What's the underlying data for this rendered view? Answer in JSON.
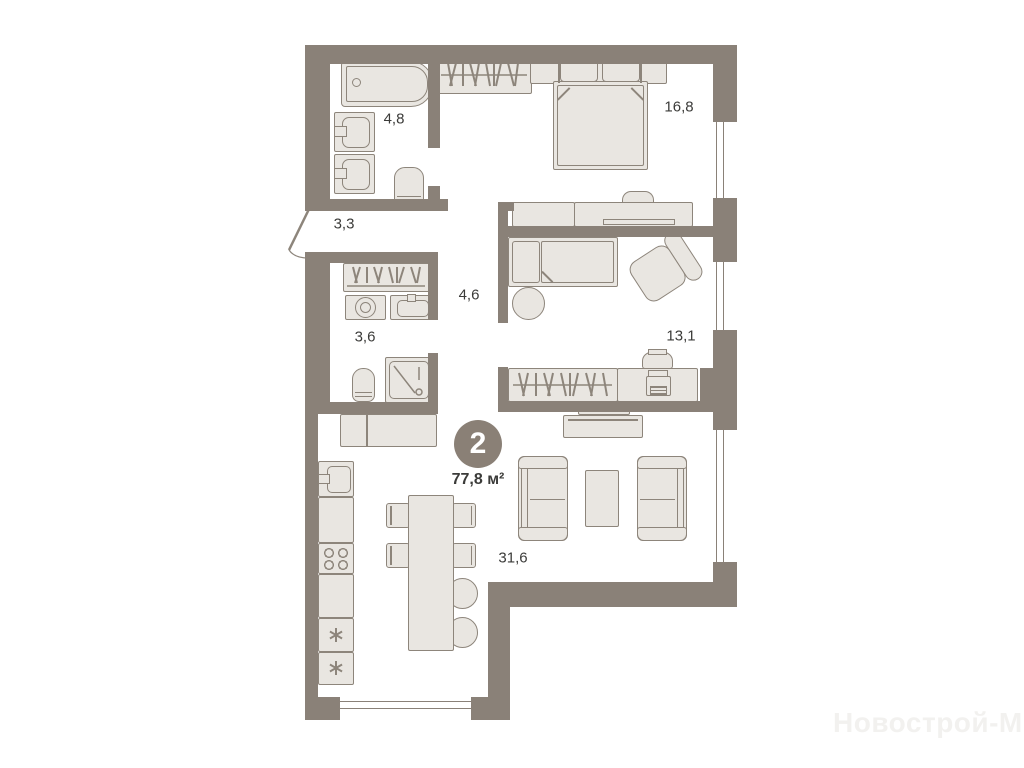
{
  "plan": {
    "badge": {
      "rooms_count": "2",
      "total_area": "77,8 м²"
    },
    "rooms": [
      {
        "id": "bathroom",
        "area": "4,8"
      },
      {
        "id": "hallway",
        "area": "3,3"
      },
      {
        "id": "laundry-wc",
        "area": "3,6"
      },
      {
        "id": "corridor",
        "area": "4,6"
      },
      {
        "id": "bedroom",
        "area": "16,8"
      },
      {
        "id": "kids-room",
        "area": "13,1"
      },
      {
        "id": "living-kitchen",
        "area": "31,6"
      }
    ],
    "watermark": "Новострой-М",
    "colors": {
      "wall": "#8a8178",
      "furniture_fill": "#e9e6e1",
      "furniture_stroke": "#8d857b",
      "text": "#3b3b39",
      "watermark": "#f2f1ef"
    }
  }
}
